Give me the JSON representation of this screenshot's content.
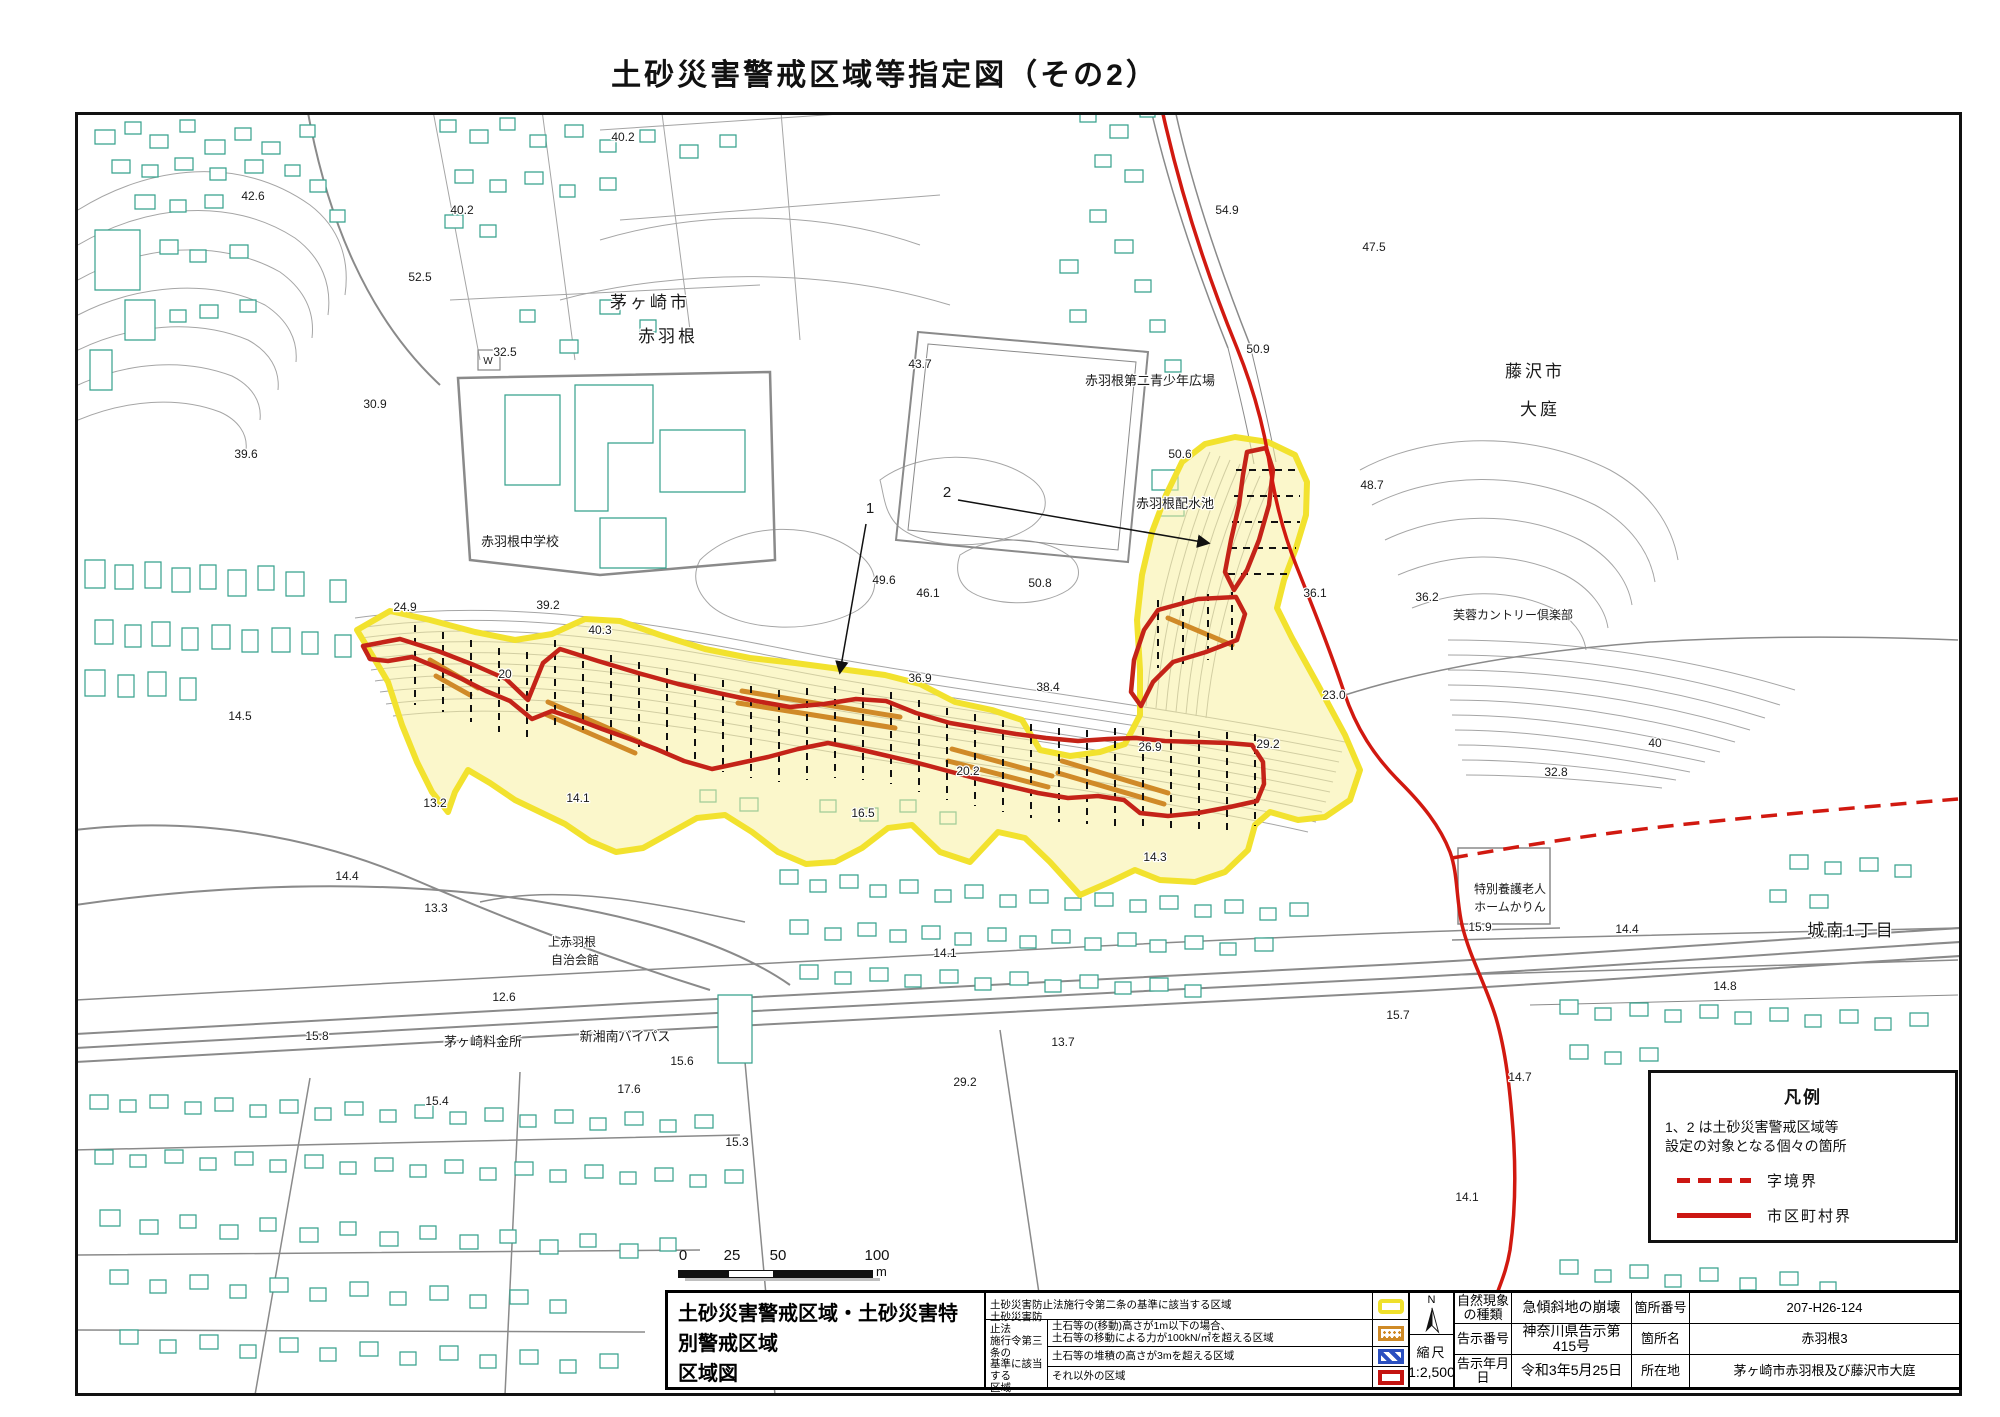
{
  "page_title": "土砂災害警戒区域等指定図（その2）",
  "map": {
    "colors": {
      "warning_zone_border": "#f2e22e",
      "warning_zone_fill": "#f8f3c0",
      "special_zone_border": "#c42318",
      "municipal_boundary_line": "#d11910",
      "aza_boundary_line": "#d11910",
      "debris_hatch": "#d08a28",
      "building_outline": "#35a18c",
      "contour_line": "#a0a0a0"
    },
    "scale_bar": {
      "ticks": [
        "0",
        "25",
        "50",
        "100"
      ],
      "unit": "m"
    },
    "labels": [
      {
        "t": "42.6",
        "x": 253,
        "y": 200
      },
      {
        "t": "40.2",
        "x": 623,
        "y": 141
      },
      {
        "t": "40.2",
        "x": 462,
        "y": 214
      },
      {
        "t": "52.5",
        "x": 420,
        "y": 281
      },
      {
        "t": "32.5",
        "x": 505,
        "y": 356
      },
      {
        "t": "30.9",
        "x": 375,
        "y": 408
      },
      {
        "t": "39.6",
        "x": 246,
        "y": 458
      },
      {
        "t": "43.7",
        "x": 920,
        "y": 368
      },
      {
        "t": "54.9",
        "x": 1227,
        "y": 214
      },
      {
        "t": "47.5",
        "x": 1374,
        "y": 251
      },
      {
        "t": "50.9",
        "x": 1258,
        "y": 353
      },
      {
        "t": "50.6",
        "x": 1180,
        "y": 458
      },
      {
        "t": "48.7",
        "x": 1372,
        "y": 489
      },
      {
        "t": "24.9",
        "x": 405,
        "y": 611
      },
      {
        "t": "39.2",
        "x": 548,
        "y": 609
      },
      {
        "t": "40.3",
        "x": 600,
        "y": 634
      },
      {
        "t": "49.6",
        "x": 884,
        "y": 584
      },
      {
        "t": "46.1",
        "x": 928,
        "y": 597
      },
      {
        "t": "50.8",
        "x": 1040,
        "y": 587
      },
      {
        "t": "36.1",
        "x": 1315,
        "y": 597
      },
      {
        "t": "36.2",
        "x": 1427,
        "y": 601
      },
      {
        "t": "23.0",
        "x": 1334,
        "y": 699
      },
      {
        "t": "38.4",
        "x": 1048,
        "y": 691
      },
      {
        "t": "36.9",
        "x": 920,
        "y": 682
      },
      {
        "t": "20",
        "x": 505,
        "y": 678
      },
      {
        "t": "29.2",
        "x": 1268,
        "y": 748
      },
      {
        "t": "26.9",
        "x": 1150,
        "y": 751
      },
      {
        "t": "20.2",
        "x": 968,
        "y": 775
      },
      {
        "t": "16.5",
        "x": 863,
        "y": 817
      },
      {
        "t": "14.3",
        "x": 1155,
        "y": 861
      },
      {
        "t": "40",
        "x": 1655,
        "y": 747
      },
      {
        "t": "32.8",
        "x": 1556,
        "y": 776
      },
      {
        "t": "14.5",
        "x": 240,
        "y": 720
      },
      {
        "t": "13.2",
        "x": 435,
        "y": 807
      },
      {
        "t": "14.1",
        "x": 578,
        "y": 802
      },
      {
        "t": "14.4",
        "x": 347,
        "y": 880
      },
      {
        "t": "13.3",
        "x": 436,
        "y": 912
      },
      {
        "t": "12.6",
        "x": 504,
        "y": 1001
      },
      {
        "t": "15.8",
        "x": 317,
        "y": 1040
      },
      {
        "t": "15.6",
        "x": 682,
        "y": 1065
      },
      {
        "t": "17.6",
        "x": 629,
        "y": 1093
      },
      {
        "t": "15.4",
        "x": 437,
        "y": 1105
      },
      {
        "t": "15.3",
        "x": 737,
        "y": 1146
      },
      {
        "t": "13.7",
        "x": 1063,
        "y": 1046
      },
      {
        "t": "15.7",
        "x": 1398,
        "y": 1019
      },
      {
        "t": "29.2",
        "x": 965,
        "y": 1086
      },
      {
        "t": "14.1",
        "x": 945,
        "y": 957
      },
      {
        "t": "15.9",
        "x": 1480,
        "y": 931
      },
      {
        "t": "14.4",
        "x": 1627,
        "y": 933
      },
      {
        "t": "14.8",
        "x": 1725,
        "y": 990
      },
      {
        "t": "14.7",
        "x": 1520,
        "y": 1081
      },
      {
        "t": "14.1",
        "x": 1467,
        "y": 1201
      },
      {
        "t": "W",
        "x": 488,
        "y": 364,
        "s": 10
      },
      {
        "t": "茅ヶ崎市",
        "x": 650,
        "y": 308,
        "s": 17,
        "sp": 3
      },
      {
        "t": "赤羽根",
        "x": 668,
        "y": 342,
        "s": 17,
        "sp": 3
      },
      {
        "t": "藤沢市",
        "x": 1535,
        "y": 377,
        "s": 17,
        "sp": 3
      },
      {
        "t": "大庭",
        "x": 1540,
        "y": 415,
        "s": 17,
        "sp": 3
      },
      {
        "t": "城南1丁目",
        "x": 1851,
        "y": 936,
        "s": 17,
        "sp": 2
      },
      {
        "t": "赤羽根中学校",
        "x": 520,
        "y": 546,
        "s": 13
      },
      {
        "t": "赤羽根第二青少年広場",
        "x": 1150,
        "y": 385,
        "s": 13
      },
      {
        "t": "赤羽根配水池",
        "x": 1175,
        "y": 508,
        "s": 13
      },
      {
        "t": "芙蓉カントリー倶楽部",
        "x": 1513,
        "y": 619,
        "s": 12
      },
      {
        "t": "上赤羽根",
        "x": 572,
        "y": 946,
        "s": 12
      },
      {
        "t": "自治会館",
        "x": 575,
        "y": 964,
        "s": 12
      },
      {
        "t": "特別養護老人",
        "x": 1510,
        "y": 893,
        "s": 12
      },
      {
        "t": "ホームかりん",
        "x": 1510,
        "y": 911,
        "s": 12
      },
      {
        "t": "茅ヶ崎料金所",
        "x": 483,
        "y": 1046,
        "s": 13
      },
      {
        "t": "新湘南バイパス",
        "x": 625,
        "y": 1041,
        "s": 13
      },
      {
        "t": "1",
        "x": 870,
        "y": 513,
        "s": 15
      },
      {
        "t": "2",
        "x": 947,
        "y": 497,
        "s": 15
      }
    ]
  },
  "legend_box": {
    "title": "凡例",
    "note_line1": "1、2 は土砂災害警戒区域等",
    "note_line2": "設定の対象となる個々の箇所",
    "dashed_line_label": "字境界",
    "solid_line_label": "市区町村界"
  },
  "info_table": {
    "map_title_line1": "土砂災害警戒区域・土砂災害特別警戒区域",
    "map_title_line2": "区域図",
    "article2_text": "土砂災害防止法施行令第二条の基準に該当する区域",
    "article3_label_l1": "土砂災害防止法",
    "article3_label_l2": "施行令第三条の",
    "article3_label_l3": "基準に該当する",
    "article3_label_l4": "区域",
    "article3_row1_l1": "土石等の(移動)高さが1m以下の場合、",
    "article3_row1_l2": "土石等の移動による力が100kN/㎡を超える区域",
    "article3_row2": "土石等の堆積の高さが3mを超える区域",
    "article3_row3": "それ以外の区域",
    "north_label": "N",
    "scale_label": "縮尺",
    "scale_value": "1:2,500",
    "phenomenon_label_l1": "自然現象",
    "phenomenon_label_l2": "の種類",
    "phenomenon_value": "急傾斜地の崩壊",
    "notice_no_label": "告示番号",
    "notice_no_value": "神奈川県告示第415号",
    "notice_date_label": "告示年月日",
    "notice_date_value": "令和3年5月25日",
    "site_no_label": "箇所番号",
    "site_no_value": "207-H26-124",
    "site_name_label": "箇所名",
    "site_name_value": "赤羽根3",
    "location_label": "所在地",
    "location_value": "茅ヶ崎市赤羽根及び藤沢市大庭"
  }
}
